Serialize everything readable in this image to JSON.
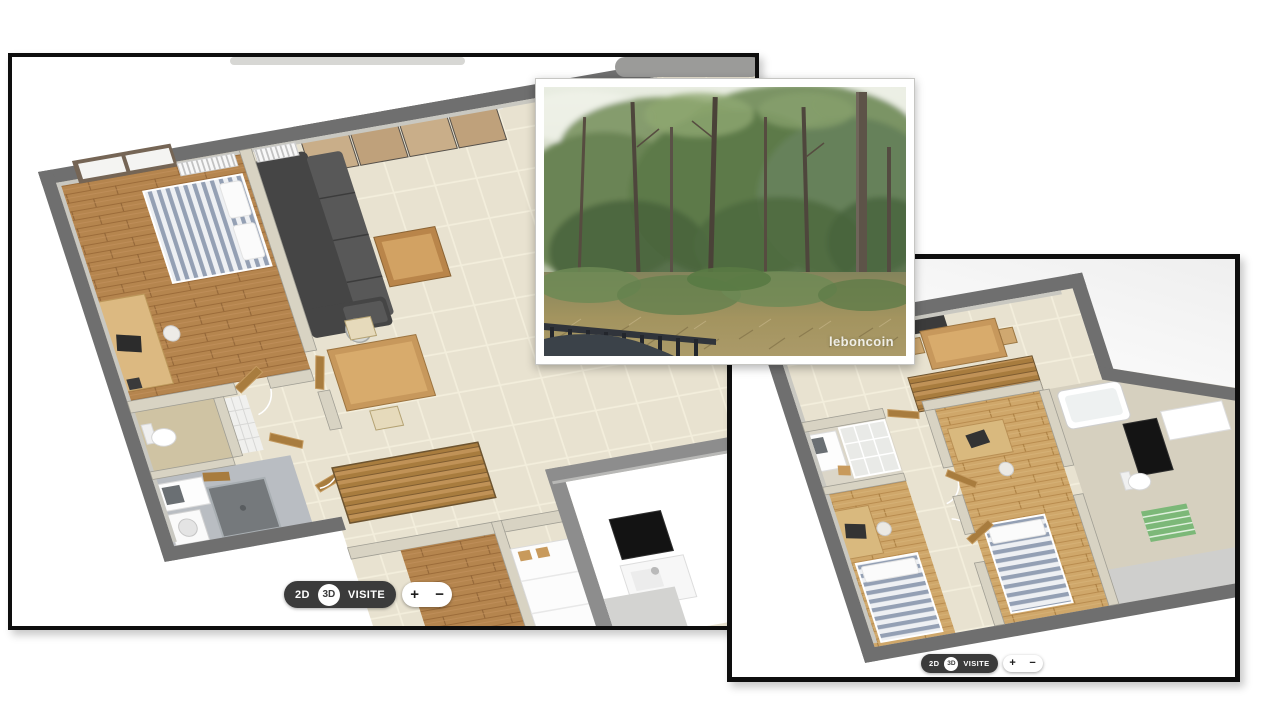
{
  "photo_card": {
    "watermark": "leboncoin"
  },
  "left_plan_card": {
    "controls": {
      "mode_2d": "2D",
      "mode_3d": "3D",
      "visit": "VISITE",
      "zoom_in": "+",
      "zoom_out": "−"
    }
  },
  "right_plan_card": {
    "controls": {
      "mode_2d": "2D",
      "mode_3d": "3D",
      "visit": "VISITE",
      "zoom_in": "+",
      "zoom_out": "−"
    }
  },
  "colors": {
    "card_border": "#0e0e0e",
    "pill_dark": "#3b3b3b",
    "wall_gray": "#6f6f6f",
    "partition_beige": "#d8d3c3",
    "tile_floor": "#e8e2d0",
    "wood_floor": "#b5854e",
    "parquet_light": "#cfa76a",
    "sofa_gray": "#474747",
    "duvet_stripe": "#94a0b4",
    "door_wood": "#a87c3e",
    "rug_green": "#7cb878",
    "forest_green": "#5d7a4a"
  }
}
